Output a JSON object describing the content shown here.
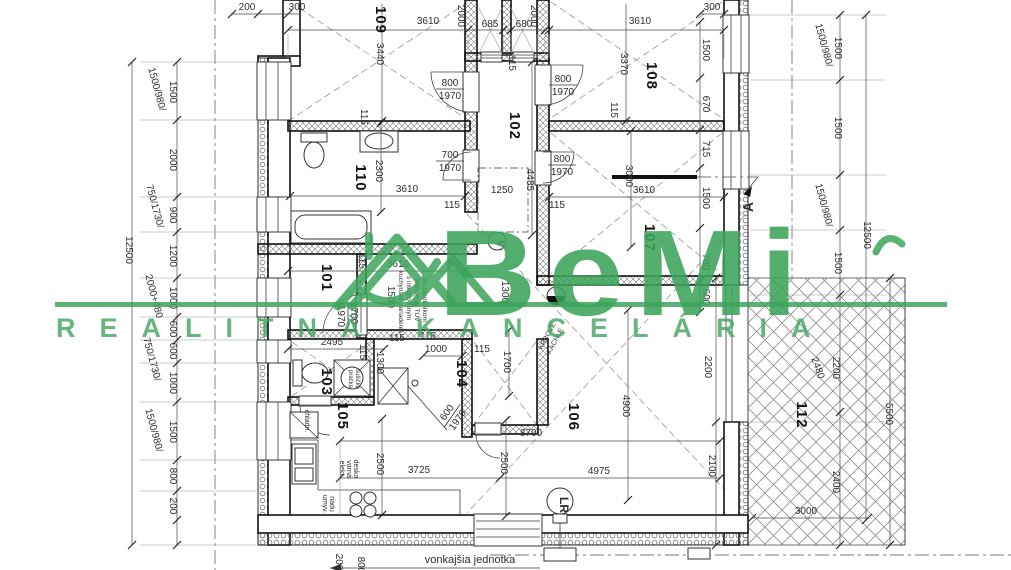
{
  "watermark": {
    "brand": "BeMi",
    "subtitle": "REALITNÁ KANCELÁRIA",
    "color": "#3da45c"
  },
  "rooms": [
    {
      "n": "109",
      "x": 376,
      "y": 20
    },
    {
      "n": "102",
      "x": 510,
      "y": 126
    },
    {
      "n": "108",
      "x": 647,
      "y": 76
    },
    {
      "n": "107",
      "x": 645,
      "y": 238
    },
    {
      "n": "110",
      "x": 356,
      "y": 178
    },
    {
      "n": "101",
      "x": 322,
      "y": 278
    },
    {
      "n": "103",
      "x": 322,
      "y": 382
    },
    {
      "n": "104",
      "x": 457,
      "y": 374
    },
    {
      "n": "105",
      "x": 338,
      "y": 416
    },
    {
      "n": "106",
      "x": 569,
      "y": 417
    },
    {
      "n": "112",
      "x": 797,
      "y": 415
    }
  ],
  "dimensions": [
    {
      "t": "200",
      "x": 247,
      "y": 10
    },
    {
      "t": "300",
      "x": 297,
      "y": 10
    },
    {
      "t": "3610",
      "x": 428,
      "y": 24
    },
    {
      "t": "2000",
      "x": 458,
      "y": 16,
      "r": 90
    },
    {
      "t": "685",
      "x": 490,
      "y": 27
    },
    {
      "t": "680",
      "x": 524,
      "y": 27
    },
    {
      "t": "2000",
      "x": 531,
      "y": 16,
      "r": 90
    },
    {
      "t": "3610",
      "x": 640,
      "y": 24
    },
    {
      "t": "300",
      "x": 712,
      "y": 10
    },
    {
      "t": "12500",
      "x": 126,
      "y": 250,
      "r": 90
    },
    {
      "t": "1500/980/",
      "x": 154,
      "y": 90,
      "r": 75
    },
    {
      "t": "1500",
      "x": 170,
      "y": 92,
      "r": 90
    },
    {
      "t": "2000",
      "x": 170,
      "y": 160,
      "r": 90
    },
    {
      "t": "750/1730/",
      "x": 152,
      "y": 207,
      "r": 75
    },
    {
      "t": "900",
      "x": 170,
      "y": 215,
      "r": 90
    },
    {
      "t": "1200",
      "x": 170,
      "y": 256,
      "r": 90
    },
    {
      "t": "2000+480",
      "x": 151,
      "y": 297,
      "r": 75
    },
    {
      "t": "1000",
      "x": 170,
      "y": 298,
      "r": 90
    },
    {
      "t": "600",
      "x": 170,
      "y": 329,
      "r": 90
    },
    {
      "t": "600",
      "x": 170,
      "y": 351,
      "r": 90
    },
    {
      "t": "750/1730/",
      "x": 149,
      "y": 360,
      "r": 75
    },
    {
      "t": "1000",
      "x": 170,
      "y": 383,
      "r": 90
    },
    {
      "t": "1500/980/",
      "x": 151,
      "y": 431,
      "r": 75
    },
    {
      "t": "1500",
      "x": 170,
      "y": 432,
      "r": 90
    },
    {
      "t": "800",
      "x": 170,
      "y": 476,
      "r": 90
    },
    {
      "t": "200",
      "x": 170,
      "y": 506,
      "r": 90
    },
    {
      "t": "1500/980/",
      "x": 821,
      "y": 46,
      "r": 75
    },
    {
      "t": "1500",
      "x": 835,
      "y": 48,
      "r": 90
    },
    {
      "t": "1500",
      "x": 835,
      "y": 128,
      "r": 90
    },
    {
      "t": "1500/980/",
      "x": 821,
      "y": 206,
      "r": 75
    },
    {
      "t": "1500",
      "x": 835,
      "y": 263,
      "r": 90
    },
    {
      "t": "12500",
      "x": 864,
      "y": 235,
      "r": 90
    },
    {
      "t": "2480",
      "x": 815,
      "y": 369,
      "r": 70
    },
    {
      "t": "2200",
      "x": 833,
      "y": 368,
      "r": 90
    },
    {
      "t": "5500",
      "x": 886,
      "y": 414,
      "r": 90
    },
    {
      "t": "2400",
      "x": 833,
      "y": 482,
      "r": 90
    },
    {
      "t": "3000",
      "x": 806,
      "y": 514
    },
    {
      "t": "1500",
      "x": 703,
      "y": 50,
      "r": 90
    },
    {
      "t": "670",
      "x": 703,
      "y": 104,
      "r": 90
    },
    {
      "t": "715",
      "x": 703,
      "y": 149,
      "r": 90
    },
    {
      "t": "1500",
      "x": 703,
      "y": 198,
      "r": 90
    },
    {
      "t": "780",
      "x": 703,
      "y": 262,
      "r": 90
    },
    {
      "t": "600",
      "x": 703,
      "y": 297,
      "r": 90
    },
    {
      "t": "3440",
      "x": 377,
      "y": 54,
      "r": 90
    },
    {
      "t": "3370",
      "x": 621,
      "y": 64,
      "r": 90
    },
    {
      "t": "115",
      "x": 361,
      "y": 117,
      "r": 90
    },
    {
      "t": "115",
      "x": 611,
      "y": 110,
      "r": 90
    },
    {
      "t": "115",
      "x": 509,
      "y": 63,
      "r": 90
    },
    {
      "t": "4485",
      "x": 527,
      "y": 180,
      "r": 90
    },
    {
      "t": "1250",
      "x": 502,
      "y": 193
    },
    {
      "t": "115",
      "x": 452,
      "y": 208
    },
    {
      "t": "115",
      "x": 557,
      "y": 208
    },
    {
      "t": "2300",
      "x": 376,
      "y": 171,
      "r": 90
    },
    {
      "t": "3610",
      "x": 407,
      "y": 192
    },
    {
      "t": "3610",
      "x": 644,
      "y": 193
    },
    {
      "t": "3000",
      "x": 626,
      "y": 176,
      "r": 90
    },
    {
      "t": "115",
      "x": 359,
      "y": 261,
      "r": 90
    },
    {
      "t": "3610",
      "x": 398,
      "y": 267
    },
    {
      "t": "1500",
      "x": 388,
      "y": 297,
      "r": 90
    },
    {
      "t": "1300",
      "x": 502,
      "y": 292,
      "r": 90
    },
    {
      "t": "2495",
      "x": 332,
      "y": 345
    },
    {
      "t": "115",
      "x": 397,
      "y": 341
    },
    {
      "t": "1300",
      "x": 377,
      "y": 363,
      "r": 90
    },
    {
      "t": "115",
      "x": 360,
      "y": 352,
      "r": 90
    },
    {
      "t": "1000",
      "x": 436,
      "y": 352
    },
    {
      "t": "115",
      "x": 482,
      "y": 352
    },
    {
      "t": "115",
      "x": 428,
      "y": 339
    },
    {
      "t": "1700",
      "x": 504,
      "y": 362,
      "r": 90
    },
    {
      "t": "2500",
      "x": 377,
      "y": 464,
      "r": 90
    },
    {
      "t": "3725",
      "x": 419,
      "y": 473
    },
    {
      "t": "2500",
      "x": 501,
      "y": 463,
      "r": 90
    },
    {
      "t": "8700",
      "x": 531,
      "y": 436
    },
    {
      "t": "4975",
      "x": 599,
      "y": 474
    },
    {
      "t": "4900",
      "x": 623,
      "y": 406,
      "r": 90
    },
    {
      "t": "2200",
      "x": 705,
      "y": 367,
      "r": 90
    },
    {
      "t": "2100",
      "x": 709,
      "y": 466,
      "r": 90
    },
    {
      "t": "200",
      "x": 336,
      "y": 562,
      "r": 90
    },
    {
      "t": "800",
      "x": 358,
      "y": 565,
      "r": 90
    }
  ],
  "door_labels": [
    {
      "w": "800",
      "h": "1970",
      "x": 450,
      "y": 89,
      "r": 0
    },
    {
      "w": "800",
      "h": "1970",
      "x": 563,
      "y": 85,
      "r": 0
    },
    {
      "w": "700",
      "h": "1970",
      "x": 450,
      "y": 161,
      "r": 0
    },
    {
      "w": "800",
      "h": "1970",
      "x": 562,
      "y": 165,
      "r": 0
    },
    {
      "w": "700",
      "h": "1970",
      "x": 348,
      "y": 316,
      "r": 90
    },
    {
      "w": "600",
      "h": "1970",
      "x": 452,
      "y": 416,
      "r": -55
    }
  ],
  "annotations": [
    {
      "t": "kuchynské zariadenie",
      "x": 399,
      "y": 302,
      "r": 90,
      "s": 6.5
    },
    {
      "t": "s integrovaným",
      "x": 407,
      "y": 298,
      "r": 90,
      "s": 6.5
    },
    {
      "t": "jednotkou TÚV",
      "x": 415,
      "y": 300,
      "r": 90,
      "s": 6.5
    },
    {
      "t": "so zásobníkom",
      "x": 423,
      "y": 300,
      "r": 90,
      "s": 6.5
    },
    {
      "t": "pračka",
      "x": 349,
      "y": 379,
      "r": 90,
      "s": 6
    },
    {
      "t": "sušička",
      "x": 356,
      "y": 379,
      "r": 90,
      "s": 6
    },
    {
      "t": "chladn.",
      "x": 305,
      "y": 421,
      "r": 90,
      "s": 7
    },
    {
      "t": "elekt.",
      "x": 340,
      "y": 469,
      "r": 90,
      "s": 7
    },
    {
      "t": "varná",
      "x": 347,
      "y": 469,
      "r": 90,
      "s": 7
    },
    {
      "t": "deska",
      "x": 354,
      "y": 469,
      "r": 90,
      "s": 7
    },
    {
      "t": "umyv.",
      "x": 323,
      "y": 504,
      "r": 90,
      "s": 7
    },
    {
      "t": "riadu",
      "x": 330,
      "y": 504,
      "r": 90,
      "s": 7
    },
    {
      "t": "KRBOVÉ",
      "x": 549,
      "y": 337,
      "r": -62,
      "s": 7
    },
    {
      "t": "KACHLE",
      "x": 557,
      "y": 342,
      "r": -62,
      "s": 7
    },
    {
      "t": "vonkajšia jednotka",
      "x": 470,
      "y": 563,
      "r": 0,
      "s": 11
    },
    {
      "t": "V",
      "x": 497,
      "y": 244,
      "r": 90,
      "s": 10,
      "b": 1
    },
    {
      "t": "LR",
      "x": 560,
      "y": 505,
      "r": 90,
      "s": 12,
      "b": 1
    },
    {
      "t": "A",
      "x": 753,
      "y": 207,
      "r": -90,
      "s": 14,
      "b": 1
    }
  ]
}
